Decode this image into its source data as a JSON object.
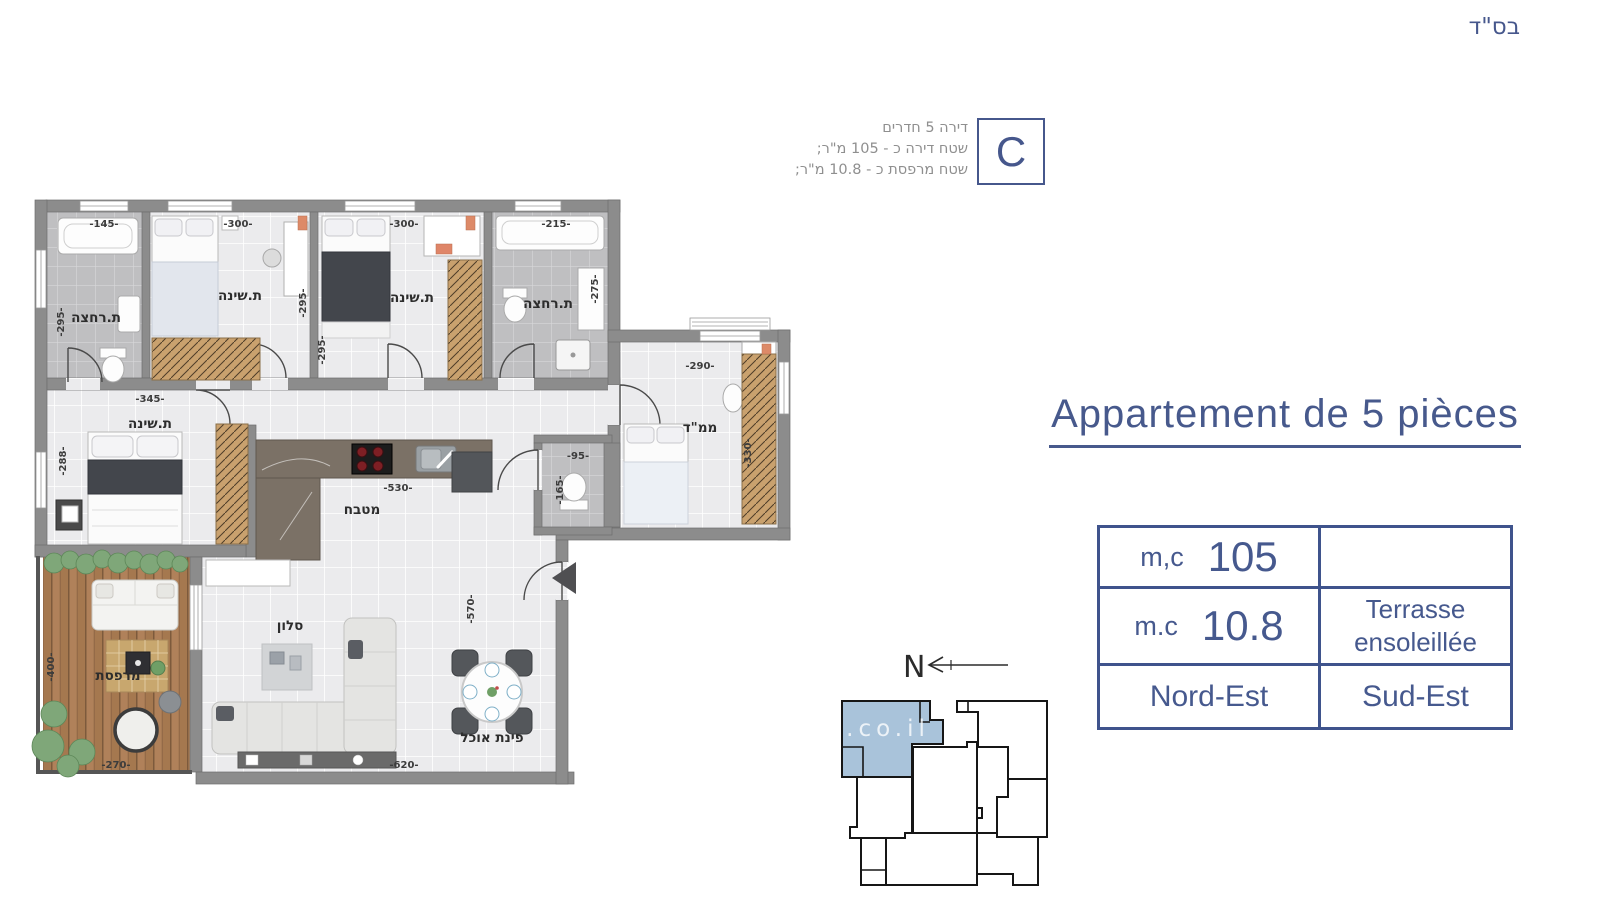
{
  "page": {
    "bsd": "בס\"ד"
  },
  "unit_info": {
    "letter": "C",
    "lines": [
      "דירה 5 חדרים",
      "שטח דירה כ - 105 מ\"ר;",
      "שטח מרפסת כ - 10.8 מ\"ר;"
    ]
  },
  "title": "Appartement de 5 pièces",
  "spec_table": {
    "row1": {
      "label": "m,c",
      "value": "105",
      "right": ""
    },
    "row2": {
      "label": "m.c",
      "value": "10.8",
      "right_line1": "Terrasse",
      "right_line2": "ensoleillée"
    },
    "row3": {
      "left": "Nord-Est",
      "right": "Sud-Est"
    }
  },
  "compass": {
    "label": "N"
  },
  "keyplan": {
    "watermark": ".co.il"
  },
  "plan": {
    "rooms": {
      "bath_top_left": {
        "label": "ת.רחצה",
        "width": "-145-",
        "height": "-295-"
      },
      "bedroom_2": {
        "label": "ת.שינה",
        "width": "-300-",
        "height": "-295-"
      },
      "bedroom_3": {
        "label": "ת.שינה",
        "width": "-300-",
        "height": "-295-"
      },
      "bath_top_right": {
        "label": "ת.רחצה",
        "width": "-215-",
        "height": "-275-"
      },
      "mamad": {
        "label": "ממ\"ד",
        "width": "-290-",
        "height": "-330-"
      },
      "wc": {
        "width": "-95-",
        "height": "-165-"
      },
      "master_bedroom": {
        "label": "ת.שינה",
        "width": "-345-",
        "height": "-288-"
      },
      "kitchen": {
        "label": "מטבח",
        "width": "-530-"
      },
      "living": {
        "label": "סלון",
        "width": "-620-",
        "height": "-570-"
      },
      "dining": {
        "label": "פינת אוכל"
      },
      "terrace": {
        "label": "מרפסת",
        "width": "-270-",
        "height": "-400-"
      }
    }
  },
  "colors": {
    "accent": "#47598c",
    "highlight": "#aac4da"
  }
}
